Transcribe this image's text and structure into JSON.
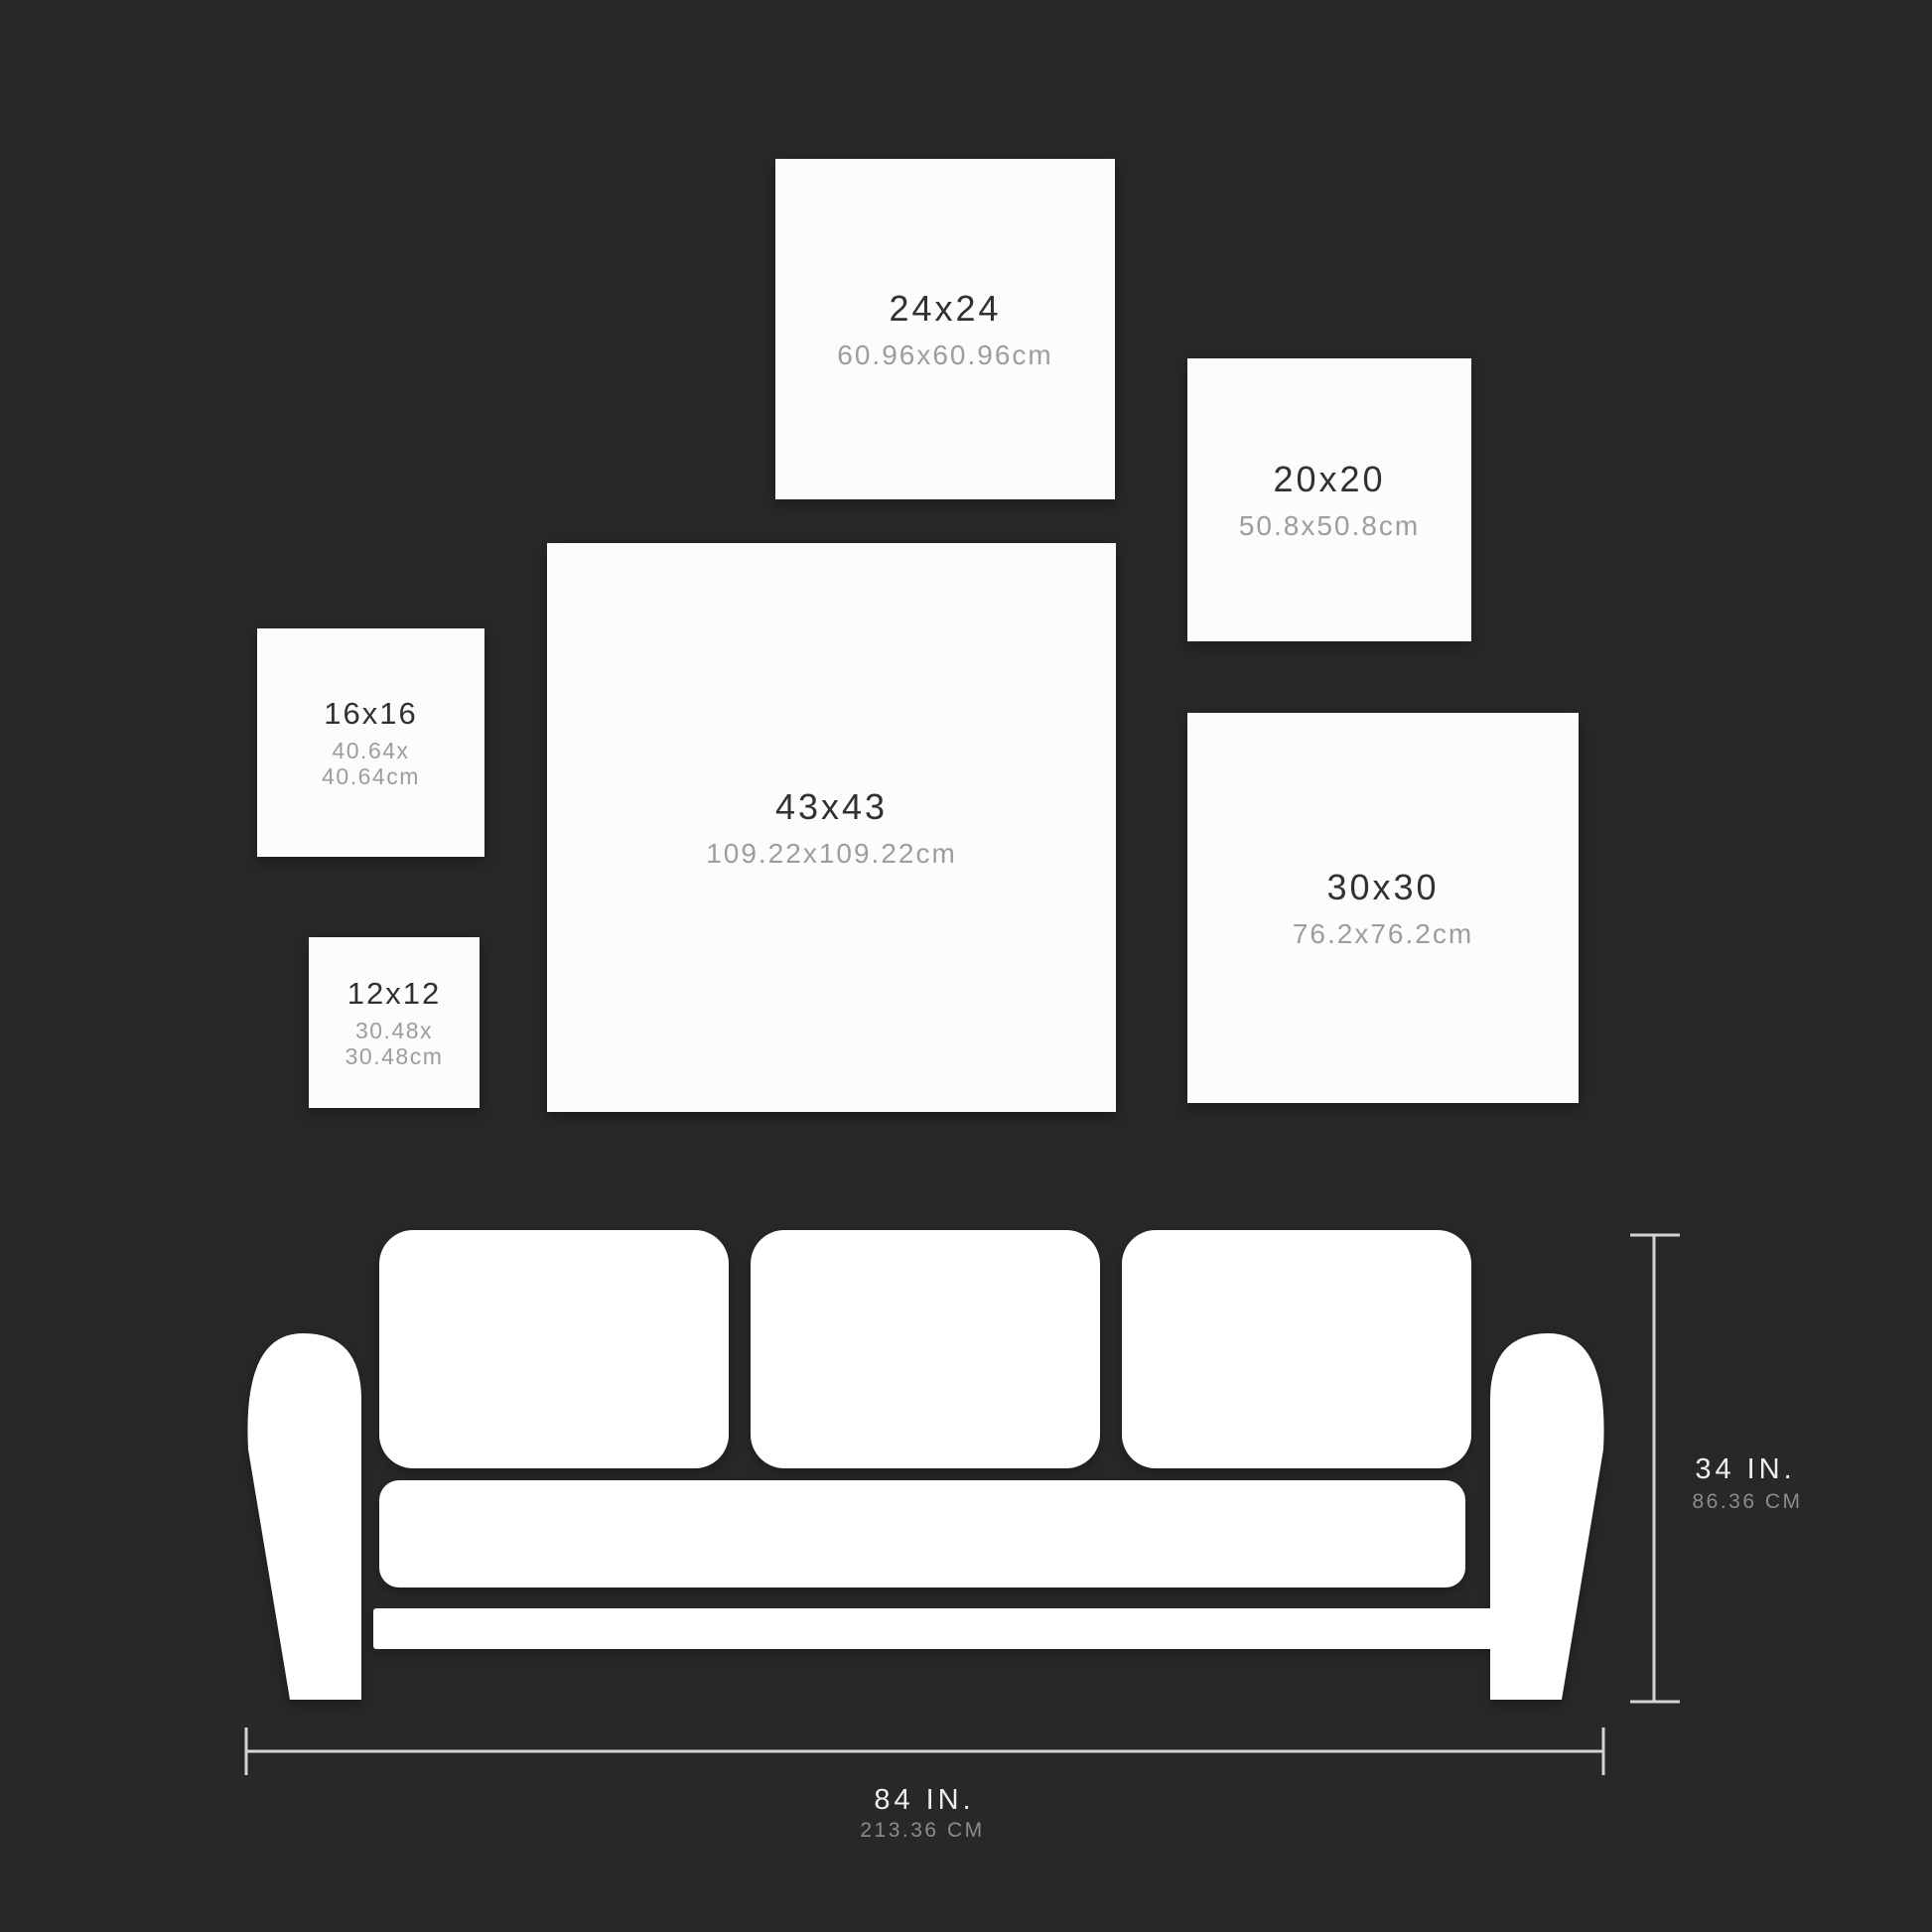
{
  "colors": {
    "background": "#282828",
    "panel": "#fcfcfc",
    "panel_size_text": "#313131",
    "panel_metric_text": "#9d9d9d",
    "sofa": "#ffffff",
    "dimension_line": "#d4d4d4",
    "dimension_in_text": "#efefef",
    "dimension_cm_text": "#8c8c8c"
  },
  "panels": [
    {
      "size_label": "24x24",
      "metric_label": "60.96x60.96cm"
    },
    {
      "size_label": "20x20",
      "metric_label": "50.8x50.8cm"
    },
    {
      "size_label": "43x43",
      "metric_label": "109.22x109.22cm"
    },
    {
      "size_label": "16x16",
      "metric_line1": "40.64x",
      "metric_line2": "40.64cm"
    },
    {
      "size_label": "12x12",
      "metric_line1": "30.48x",
      "metric_line2": "30.48cm"
    },
    {
      "size_label": "30x30",
      "metric_label": "76.2x76.2cm"
    }
  ],
  "sofa": {
    "height_label": "34 IN.",
    "height_metric": "86.36 CM",
    "width_label": "84 IN.",
    "width_metric": "213.36 CM"
  }
}
